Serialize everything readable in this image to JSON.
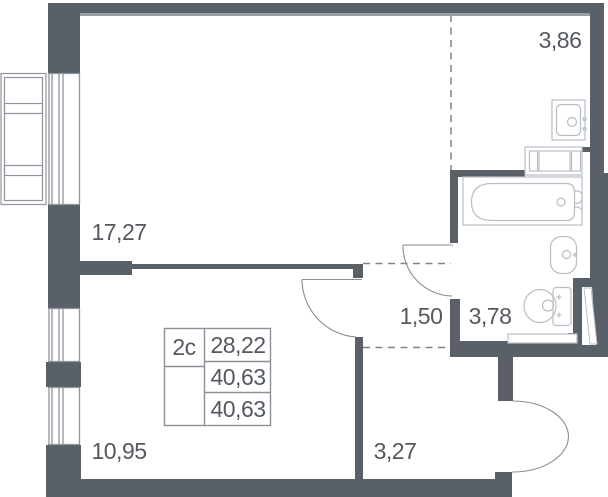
{
  "unit": {
    "type_label": "2с",
    "stats": [
      "28,22",
      "40,63",
      "40,63"
    ]
  },
  "rooms": [
    {
      "name": "living-room",
      "area": "17,27"
    },
    {
      "name": "entry-hall",
      "area": "3,86"
    },
    {
      "name": "corridor",
      "area": "1,50"
    },
    {
      "name": "bathroom",
      "area": "3,78"
    },
    {
      "name": "bedroom",
      "area": "10,95"
    },
    {
      "name": "kitchen-niche",
      "area": "3,27"
    }
  ],
  "colors": {
    "wall": "#5a6067",
    "wall_light": "#9aa0a6",
    "window": "#8f959c",
    "fixture": "#b9bec4",
    "door_arc": "#878d94",
    "dash": "#7e848b",
    "table_border": "#8b9199",
    "text": "#545960",
    "background": "#ffffff"
  }
}
